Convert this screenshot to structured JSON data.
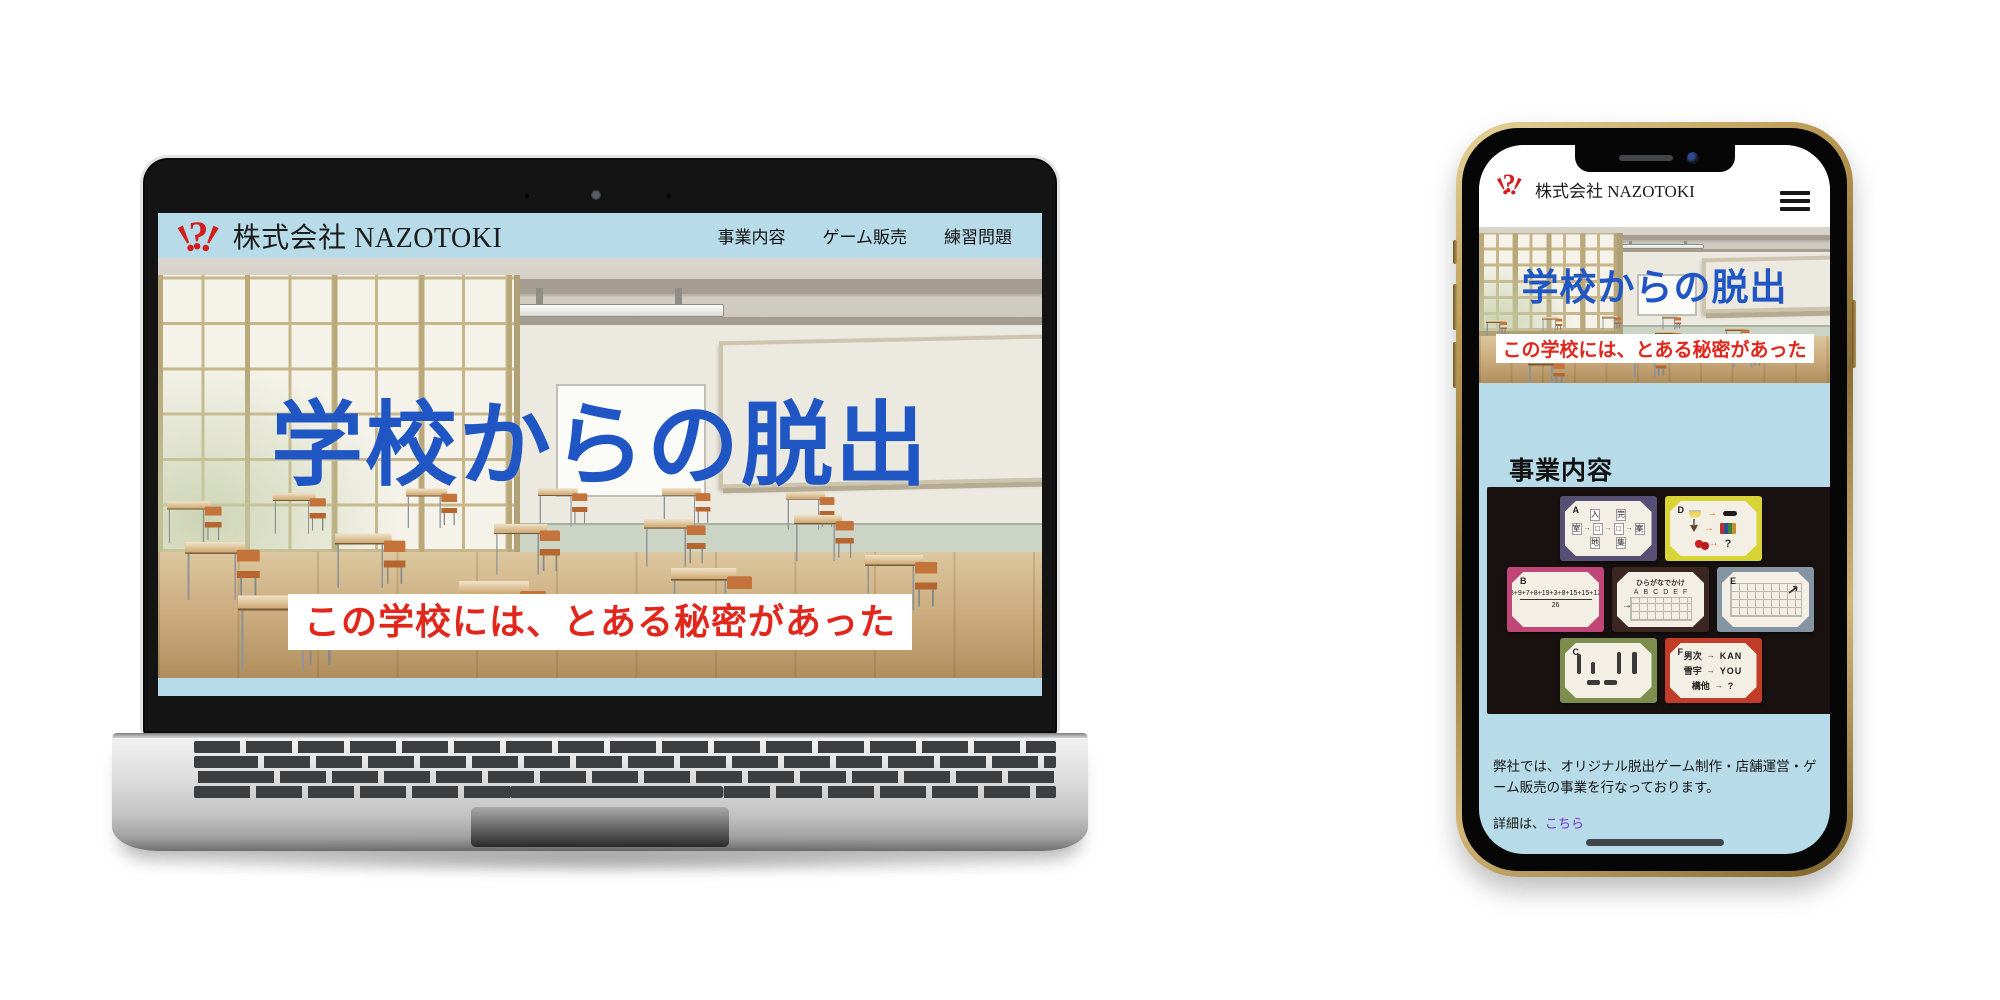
{
  "brand": {
    "name": "株式会社 NAZOTOKI",
    "logo": {
      "left": "!",
      "center": "?",
      "right": "!"
    }
  },
  "nav": {
    "items": [
      {
        "label": "事業内容"
      },
      {
        "label": "ゲーム販売"
      },
      {
        "label": "練習問題"
      }
    ]
  },
  "hero": {
    "title": "学校からの脱出",
    "subtitle": "この学校には、とある秘密があった"
  },
  "business": {
    "heading": "事業内容",
    "description": "弊社では、オリジナル脱出ゲーム制作・店舗運営・ゲーム販売の事業を行なっております。",
    "detail_prefix": "詳細は、",
    "detail_link_label": "こちら"
  },
  "shop": {
    "heading": "ゲーム販売"
  },
  "puzzle_cards": {
    "a": {
      "label": "A",
      "top": [
        "入",
        "完"
      ],
      "mid_left": "室",
      "box": "□",
      "mid_right": "案",
      "bottom": [
        "地",
        "集"
      ],
      "arrow": "→"
    },
    "b": {
      "label": "B",
      "numerator": "8+9+7+8+19+3+8+15+15+12",
      "denominator": "26"
    },
    "c": {
      "label": "C"
    },
    "d": {
      "label": "D",
      "arrow": "→",
      "q": "?"
    },
    "e": {
      "label": "E",
      "arrow_glyph": "↗"
    },
    "f": {
      "label": "F",
      "arrow": "→",
      "rows": [
        {
          "left": "男次",
          "right": "KAN"
        },
        {
          "left": "雪宇",
          "right": "YOU"
        },
        {
          "left": "構他",
          "right": "?"
        }
      ]
    },
    "hira": {
      "title": "ひらがなでかけ",
      "letters": [
        "A",
        "B",
        "C",
        "D",
        "E",
        "F"
      ],
      "arrow": "→"
    }
  },
  "colors": {
    "page_blue": "#b7dbe8",
    "title_blue": "#2056c4",
    "accent_red": "#e1261c",
    "logo_red": "#d41d1d",
    "link_purple": "#7b2fc4"
  }
}
